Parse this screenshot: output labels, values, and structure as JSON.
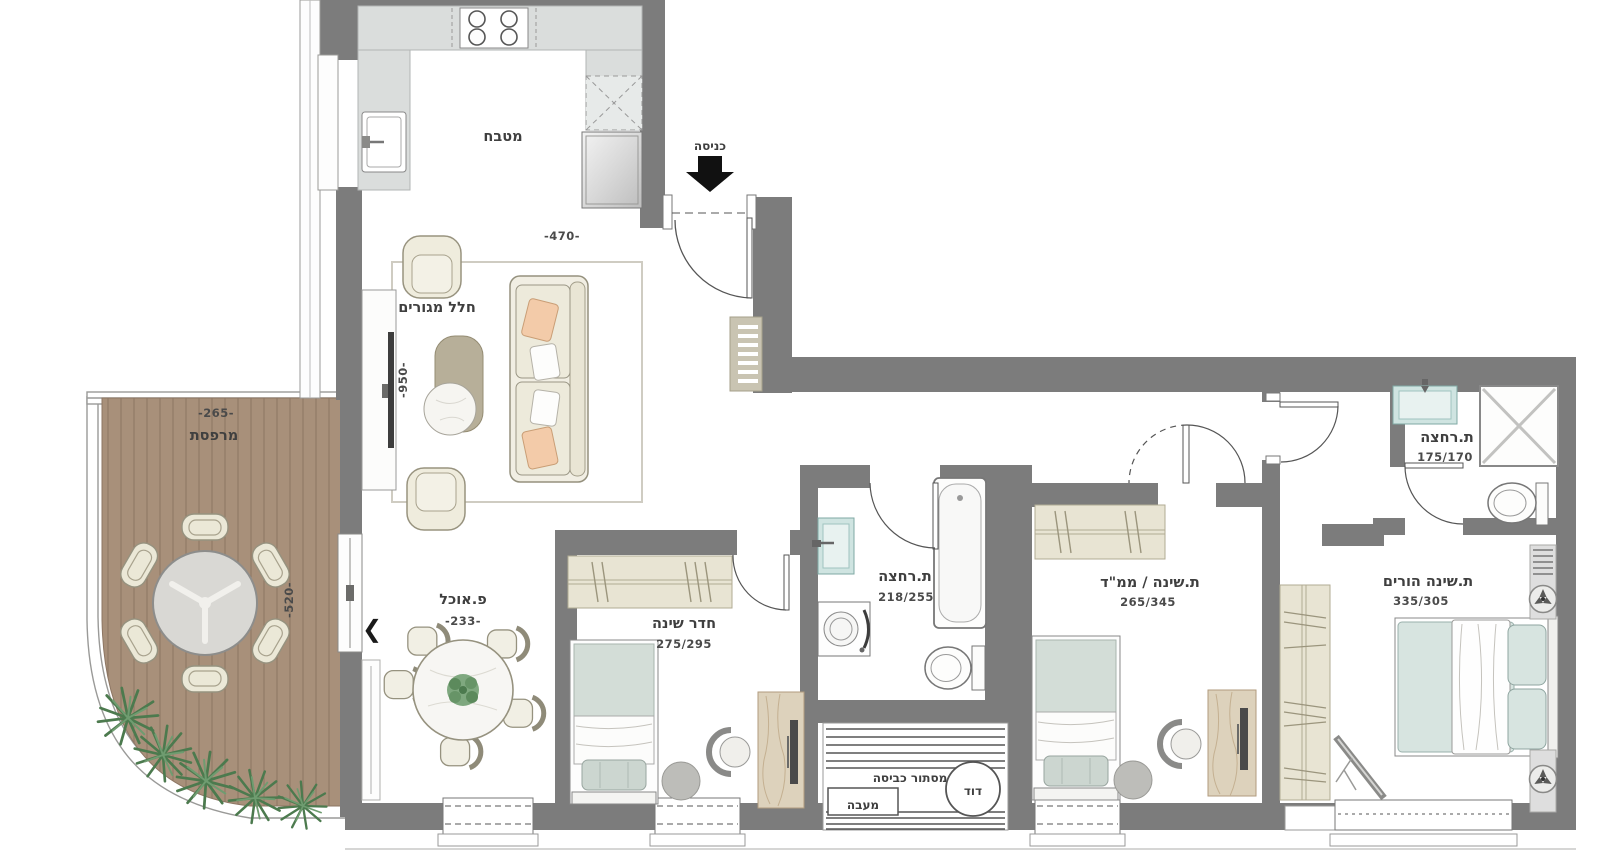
{
  "title": "Apartment floor plan",
  "colors": {
    "wall": "#7c7c7c",
    "deck": "#a8907a",
    "deck_line": "#8d7663",
    "counter": "#dadddc",
    "closet": "#e8e4d3",
    "mattress": "#d3ddd7",
    "master_mattress": "#d7e4e0",
    "sofa": "#f1eee3",
    "pillow_peach": "#f3cba9",
    "sink": "#cfe4e1",
    "plant": "#4c7a4e",
    "text": "#3f3f3f"
  },
  "rooms": {
    "kitchen": {
      "label": "מטבח"
    },
    "entrance": {
      "label": "כניסה"
    },
    "living": {
      "label": "חלל מגורים",
      "dim_width": "-470-",
      "dim_height": "-950-"
    },
    "balcony": {
      "label": "מרפסת",
      "dim_width": "-265-",
      "dim_height": "-520-"
    },
    "dining": {
      "label": "פ.אוכל",
      "dim": "-233-"
    },
    "bedroom1": {
      "label": "חדר שינה",
      "dim": "275/295"
    },
    "bathroom": {
      "label": "ת.רחצה",
      "dim": "218/255"
    },
    "mamad": {
      "label": "ת.שינה / ממ\"ד",
      "dim": "265/345"
    },
    "master": {
      "label": "ת.שינה הורים",
      "dim": "335/305"
    },
    "master_bath": {
      "label": "ת.רחצה",
      "dim": "175/170"
    },
    "laundry": {
      "label": "מסתור כביסה",
      "condenser": "מעבה",
      "boiler": "דוד"
    }
  },
  "icons": {
    "slider_arrow": "❮"
  }
}
